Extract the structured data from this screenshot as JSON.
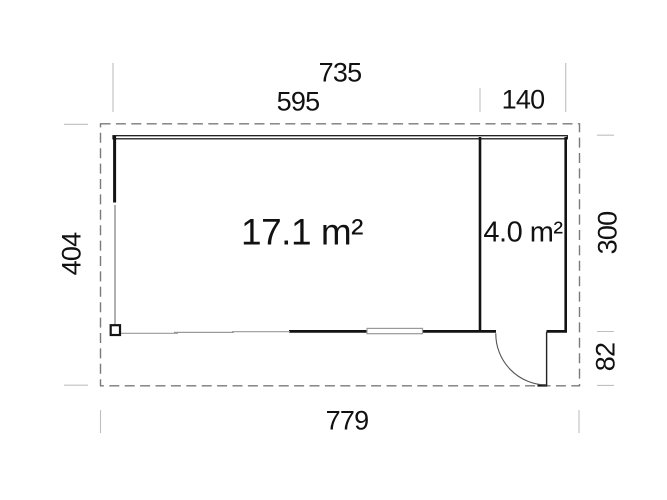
{
  "diagram": {
    "type": "floor-plan",
    "rooms": {
      "main": {
        "area_label": "17.1 m²"
      },
      "side": {
        "area_label": "4.0 m²"
      }
    },
    "dimensions": {
      "top_total": "735",
      "top_main": "595",
      "top_side": "140",
      "left_depth": "404",
      "right_room_depth": "300",
      "right_overhang": "82",
      "bottom_total": "779"
    },
    "colors": {
      "wall": "#131313",
      "thin_wall": "#9a9a9a",
      "roof_dash": "#7a7a7a",
      "extension_tick": "#bfbfbf",
      "text": "#111111",
      "background": "#ffffff"
    }
  }
}
